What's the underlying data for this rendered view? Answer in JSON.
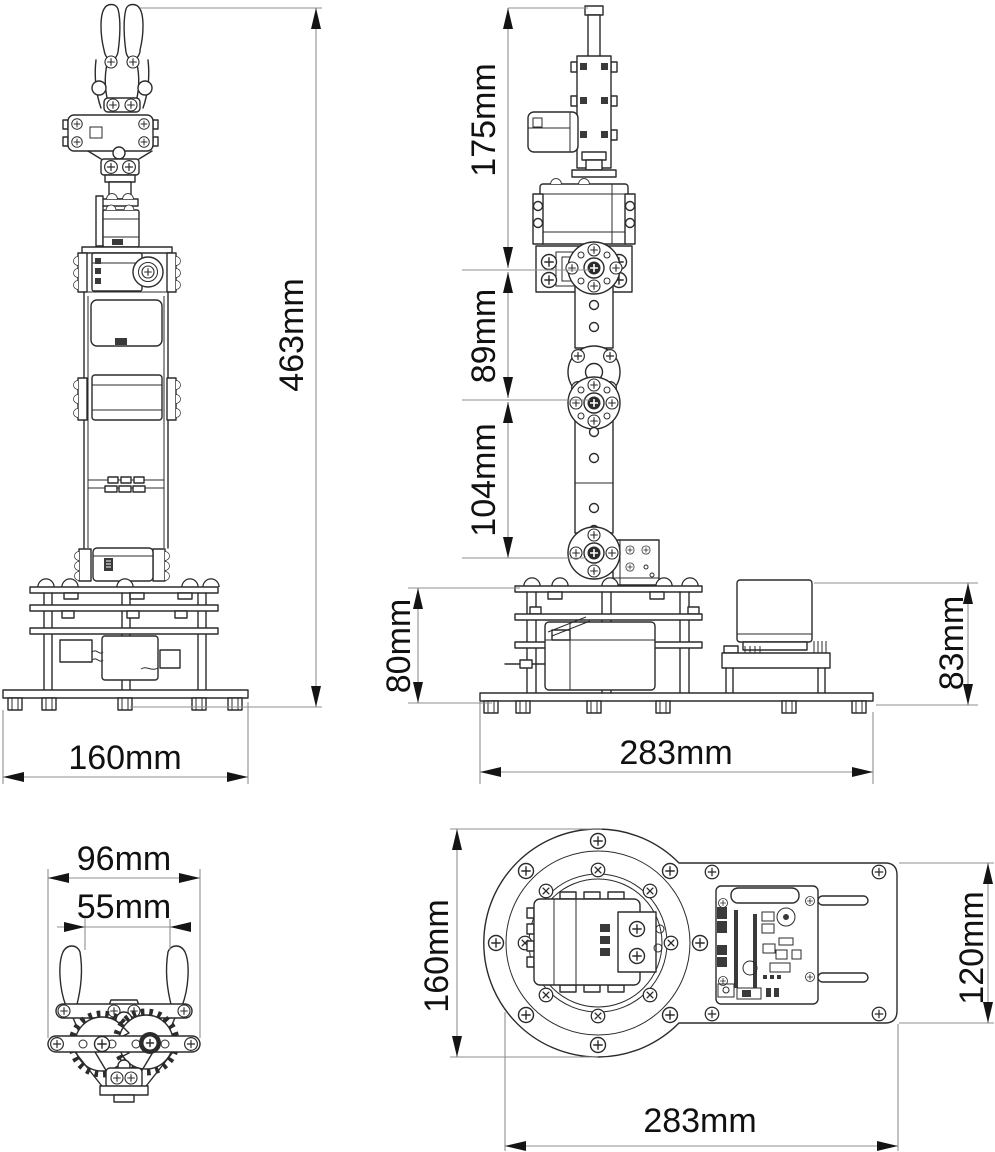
{
  "colors": {
    "background": "#ffffff",
    "drawing_line": "#2b2b2b",
    "dimension_line": "#8f8f8f",
    "dimension_text": "#111111"
  },
  "dimensions": {
    "front_height": "463mm",
    "front_base_width": "160mm",
    "side_upper_segment": "175mm",
    "side_middle_segment": "89mm",
    "side_lower_segment": "104mm",
    "side_base_height": "80mm",
    "side_base_length": "283mm",
    "side_controller_height": "83mm",
    "gripper_outer_width": "96mm",
    "gripper_opening_width": "55mm",
    "top_plate_depth": "160mm",
    "top_plate_width": "120mm",
    "top_overall_length": "283mm"
  }
}
